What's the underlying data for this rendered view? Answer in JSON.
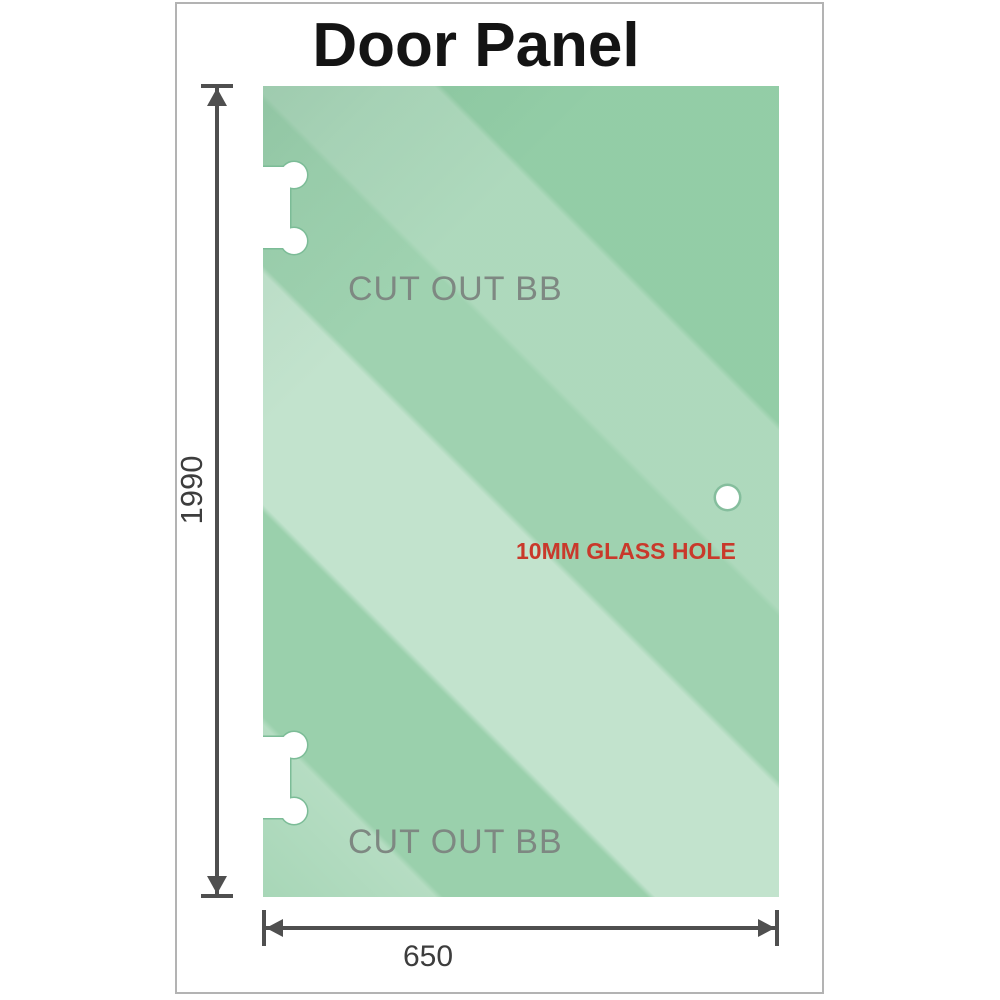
{
  "title": "Door Panel",
  "panel": {
    "cutout_top_label": "CUT OUT BB",
    "cutout_bottom_label": "CUT OUT BB",
    "hole_label": "10MM GLASS HOLE"
  },
  "dimensions": {
    "height_mm": "1990",
    "width_mm": "650"
  },
  "colors": {
    "glass_base": "#8fcba3",
    "frame_border": "#b3b3b3",
    "dimension_line": "#4f4f4f",
    "dim_text": "#3d3d3d",
    "title_color": "#141414",
    "hole_label_red": "#c9392b",
    "cutout_label_gray": "#7e8882",
    "cutout_outline": "#7cbc97"
  }
}
